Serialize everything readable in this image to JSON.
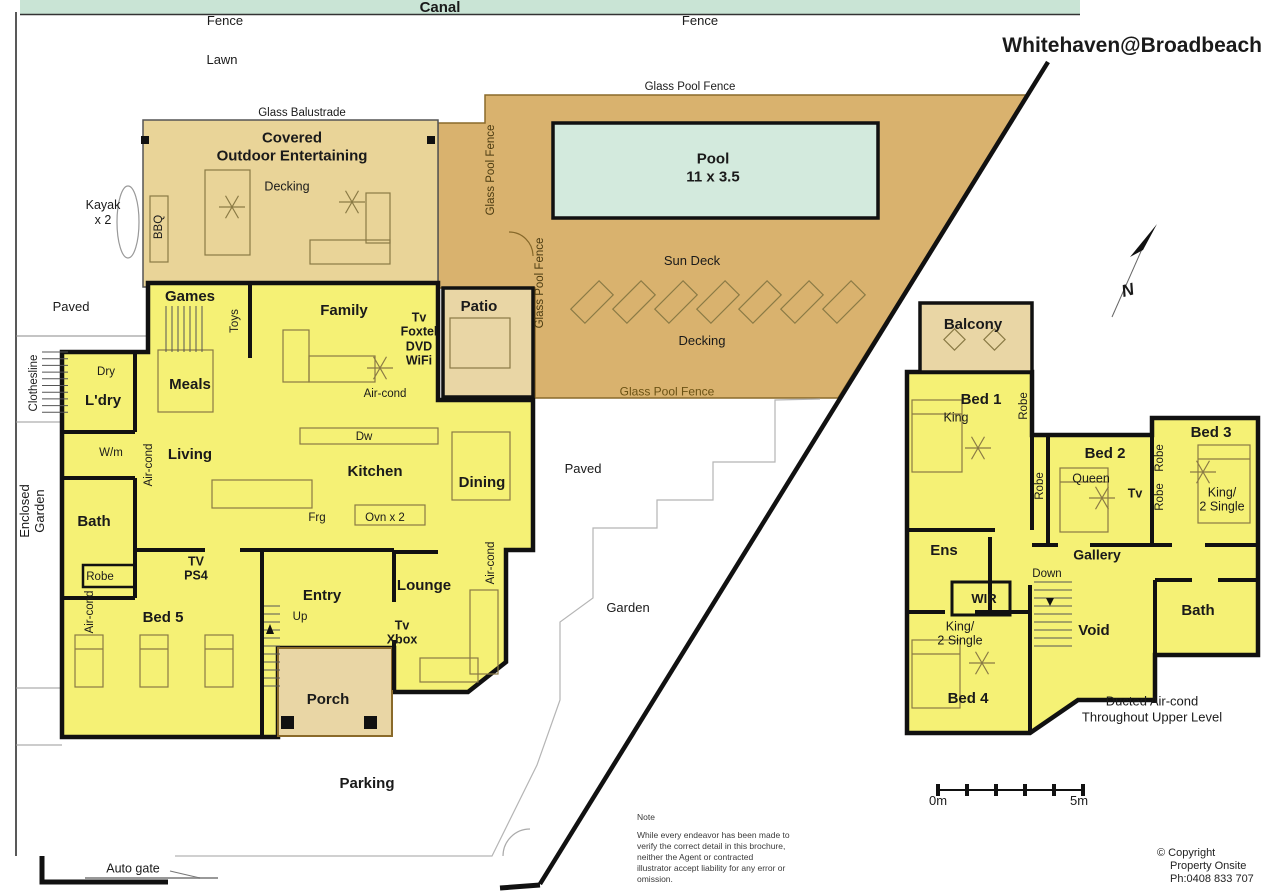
{
  "title": "Whitehaven@Broadbeach",
  "colors": {
    "canal": "#c9e4d5",
    "pool": "#d3eadd",
    "deck": "#d9b26e",
    "covered": "#e9d498",
    "patio": "#e9d6a5",
    "room": "#f5f175",
    "wall": "#111111",
    "fence_text": "#5a4512"
  },
  "labels": [
    {
      "n": "canal",
      "t": "Canal",
      "x": 440,
      "y": 8,
      "s": 15,
      "b": 1
    },
    {
      "n": "fence-left",
      "t": "Fence",
      "x": 225,
      "y": 21
    },
    {
      "n": "fence-right",
      "t": "Fence",
      "x": 700,
      "y": 21
    },
    {
      "n": "lawn",
      "t": "Lawn",
      "x": 222,
      "y": 60
    },
    {
      "n": "plan-title",
      "t": "Whitehaven@Broadbeach",
      "x": 1262,
      "y": 46,
      "s": 21,
      "b": 1,
      "a": "r"
    },
    {
      "n": "glass-balustrade",
      "t": "Glass Balustrade",
      "x": 302,
      "y": 113,
      "s": 11.5
    },
    {
      "n": "covered-outdoor",
      "t": "Covered\nOutdoor Entertaining",
      "x": 292,
      "y": 148,
      "s": 15,
      "b": 1
    },
    {
      "n": "decking-covered",
      "t": "Decking",
      "x": 287,
      "y": 187,
      "s": 12.5
    },
    {
      "n": "kayak",
      "t": "Kayak\nx 2",
      "x": 103,
      "y": 213,
      "s": 12.5
    },
    {
      "n": "bbq",
      "t": "BBQ",
      "x": 159,
      "y": 227,
      "s": 11.5,
      "r": -90
    },
    {
      "n": "glass-pool-fence-top",
      "t": "Glass Pool Fence",
      "x": 690,
      "y": 87,
      "s": 11.5
    },
    {
      "n": "glass-pool-fence-v1",
      "t": "Glass Pool Fence",
      "x": 491,
      "y": 170,
      "s": 11.5,
      "r": -90,
      "c": "#4a3a10"
    },
    {
      "n": "glass-pool-fence-v2",
      "t": "Glass Pool Fence",
      "x": 540,
      "y": 283,
      "s": 11.5,
      "r": -90,
      "c": "#4a3a10"
    },
    {
      "n": "pool",
      "t": "Pool\n11 x 3.5",
      "x": 713,
      "y": 169,
      "s": 15,
      "b": 1
    },
    {
      "n": "sun-deck",
      "t": "Sun Deck",
      "x": 692,
      "y": 261,
      "s": 13
    },
    {
      "n": "decking-deck",
      "t": "Decking",
      "x": 702,
      "y": 341,
      "s": 13
    },
    {
      "n": "glass-pool-fence-bottom",
      "t": "Glass Pool Fence",
      "x": 667,
      "y": 392,
      "s": 12,
      "c": "#6b5215"
    },
    {
      "n": "paved-left",
      "t": "Paved",
      "x": 71,
      "y": 307
    },
    {
      "n": "clothesline",
      "t": "Clothesline",
      "x": 34,
      "y": 383,
      "s": 11.5,
      "r": -90
    },
    {
      "n": "enclosed-garden",
      "t": "Enclosed\nGarden",
      "x": 33,
      "y": 511,
      "s": 13,
      "r": -90,
      "lh": 1.15
    },
    {
      "n": "paved-mid",
      "t": "Paved",
      "x": 583,
      "y": 469
    },
    {
      "n": "garden",
      "t": "Garden",
      "x": 628,
      "y": 608
    },
    {
      "n": "parking",
      "t": "Parking",
      "x": 367,
      "y": 784,
      "s": 15,
      "b": 1
    },
    {
      "n": "auto-gate",
      "t": "Auto gate",
      "x": 133,
      "y": 869,
      "s": 12.5
    },
    {
      "n": "north-n",
      "t": "N",
      "x": 1128,
      "y": 291,
      "s": 17,
      "b": 1,
      "i": 1,
      "r": -15
    },
    {
      "n": "games",
      "t": "Games",
      "x": 190,
      "y": 297,
      "s": 15,
      "b": 1
    },
    {
      "n": "toys",
      "t": "Toys",
      "x": 235,
      "y": 321,
      "s": 11.5,
      "r": -90
    },
    {
      "n": "family",
      "t": "Family",
      "x": 344,
      "y": 311,
      "s": 15,
      "b": 1
    },
    {
      "n": "tv-foxtel-dvd-wifi",
      "t": "Tv\nFoxtel\nDVD\nWiFi",
      "x": 419,
      "y": 339,
      "s": 12.5,
      "b": 1,
      "lh": 1.15
    },
    {
      "n": "aircond-family",
      "t": "Air-cond",
      "x": 385,
      "y": 394,
      "s": 11.5
    },
    {
      "n": "patio",
      "t": "Patio",
      "x": 479,
      "y": 307,
      "s": 15,
      "b": 1
    },
    {
      "n": "dry",
      "t": "Dry",
      "x": 106,
      "y": 372,
      "s": 11.5
    },
    {
      "n": "ldry",
      "t": "L'dry",
      "x": 103,
      "y": 401,
      "s": 15,
      "b": 1
    },
    {
      "n": "meals",
      "t": "Meals",
      "x": 190,
      "y": 385,
      "s": 15,
      "b": 1
    },
    {
      "n": "wm",
      "t": "W/m",
      "x": 111,
      "y": 453,
      "s": 11.5
    },
    {
      "n": "living",
      "t": "Living",
      "x": 190,
      "y": 455,
      "s": 15,
      "b": 1
    },
    {
      "n": "aircond-living",
      "t": "Air-cond",
      "x": 149,
      "y": 465,
      "s": 11.5,
      "r": -90
    },
    {
      "n": "dw",
      "t": "Dw",
      "x": 364,
      "y": 437,
      "s": 11.5
    },
    {
      "n": "kitchen",
      "t": "Kitchen",
      "x": 375,
      "y": 472,
      "s": 15,
      "b": 1
    },
    {
      "n": "dining",
      "t": "Dining",
      "x": 482,
      "y": 483,
      "s": 15,
      "b": 1
    },
    {
      "n": "frg",
      "t": "Frg",
      "x": 317,
      "y": 518,
      "s": 11.5
    },
    {
      "n": "ovn",
      "t": "Ovn x 2",
      "x": 385,
      "y": 518,
      "s": 11.5
    },
    {
      "n": "bath-ground",
      "t": "Bath",
      "x": 94,
      "y": 522,
      "s": 15,
      "b": 1
    },
    {
      "n": "robe-ground",
      "t": "Robe",
      "x": 100,
      "y": 577,
      "s": 11.5
    },
    {
      "n": "aircond-bed5",
      "t": "Air-cond",
      "x": 90,
      "y": 612,
      "s": 11.5,
      "r": -90
    },
    {
      "n": "bed5",
      "t": "Bed 5",
      "x": 163,
      "y": 618,
      "s": 15,
      "b": 1
    },
    {
      "n": "tv-ps4",
      "t": "TV\nPS4",
      "x": 196,
      "y": 569,
      "s": 12.5,
      "b": 1,
      "lh": 1.15
    },
    {
      "n": "entry",
      "t": "Entry",
      "x": 322,
      "y": 596,
      "s": 15,
      "b": 1
    },
    {
      "n": "up",
      "t": "Up",
      "x": 300,
      "y": 617,
      "s": 11.5
    },
    {
      "n": "lounge",
      "t": "Lounge",
      "x": 424,
      "y": 586,
      "s": 15,
      "b": 1
    },
    {
      "n": "tv-xbox",
      "t": "Tv\nXbox",
      "x": 402,
      "y": 633,
      "s": 12.5,
      "b": 1,
      "lh": 1.15
    },
    {
      "n": "aircond-lounge",
      "t": "Air-cond",
      "x": 491,
      "y": 563,
      "s": 11.5,
      "r": -90
    },
    {
      "n": "porch",
      "t": "Porch",
      "x": 328,
      "y": 700,
      "s": 15,
      "b": 1
    },
    {
      "n": "balcony",
      "t": "Balcony",
      "x": 973,
      "y": 325,
      "s": 15,
      "b": 1
    },
    {
      "n": "bed1",
      "t": "Bed 1",
      "x": 981,
      "y": 400,
      "s": 15,
      "b": 1
    },
    {
      "n": "king-bed1",
      "t": "King",
      "x": 956,
      "y": 418,
      "s": 12.5
    },
    {
      "n": "robe-bed1",
      "t": "Robe",
      "x": 1024,
      "y": 406,
      "s": 11.5,
      "r": -90
    },
    {
      "n": "robe-hall",
      "t": "Robe",
      "x": 1040,
      "y": 486,
      "s": 11.5,
      "r": -90
    },
    {
      "n": "bed2",
      "t": "Bed 2",
      "x": 1105,
      "y": 454,
      "s": 15,
      "b": 1
    },
    {
      "n": "queen-bed2",
      "t": "Queen",
      "x": 1091,
      "y": 479,
      "s": 12.5
    },
    {
      "n": "tv-bed2",
      "t": "Tv",
      "x": 1135,
      "y": 494,
      "s": 12.5,
      "b": 1
    },
    {
      "n": "robe-bed3-a",
      "t": "Robe",
      "x": 1160,
      "y": 458,
      "s": 11.5,
      "r": -90
    },
    {
      "n": "robe-bed3-b",
      "t": "Robe",
      "x": 1160,
      "y": 497,
      "s": 11.5,
      "r": -90
    },
    {
      "n": "bed3",
      "t": "Bed 3",
      "x": 1211,
      "y": 433,
      "s": 15,
      "b": 1
    },
    {
      "n": "king-2single-bed3",
      "t": "King/\n2 Single",
      "x": 1222,
      "y": 500,
      "s": 12.5,
      "lh": 1.15
    },
    {
      "n": "ens",
      "t": "Ens",
      "x": 944,
      "y": 551,
      "s": 15,
      "b": 1
    },
    {
      "n": "gallery",
      "t": "Gallery",
      "x": 1097,
      "y": 555,
      "s": 14,
      "b": 1
    },
    {
      "n": "down",
      "t": "Down",
      "x": 1047,
      "y": 574,
      "s": 11.5
    },
    {
      "n": "wir",
      "t": "WIR",
      "x": 984,
      "y": 599,
      "s": 13,
      "b": 1
    },
    {
      "n": "king-2single-bed4",
      "t": "King/\n2 Single",
      "x": 960,
      "y": 634,
      "s": 12.5,
      "lh": 1.15
    },
    {
      "n": "bed4",
      "t": "Bed 4",
      "x": 968,
      "y": 699,
      "s": 15,
      "b": 1
    },
    {
      "n": "void",
      "t": "Void",
      "x": 1094,
      "y": 631,
      "s": 15,
      "b": 1
    },
    {
      "n": "bath-upper",
      "t": "Bath",
      "x": 1198,
      "y": 611,
      "s": 15,
      "b": 1
    },
    {
      "n": "ducted-aircond",
      "t": "Ducted Air-cond\nThroughout Upper Level",
      "x": 1152,
      "y": 709,
      "s": 13,
      "lh": 1.2
    },
    {
      "n": "scale-0m",
      "t": "0m",
      "x": 938,
      "y": 801
    },
    {
      "n": "scale-5m",
      "t": "5m",
      "x": 1079,
      "y": 801
    }
  ],
  "note": {
    "heading": "Note",
    "lines": [
      "While every endeavor has been made to",
      "verify the correct detail in this brochure,",
      "neither the Agent or contracted",
      "illustrator accept liability for any error or",
      "omission."
    ]
  },
  "copyright": {
    "lines": [
      "© Copyright",
      "Property Onsite",
      "Ph:0408 833 707"
    ]
  }
}
